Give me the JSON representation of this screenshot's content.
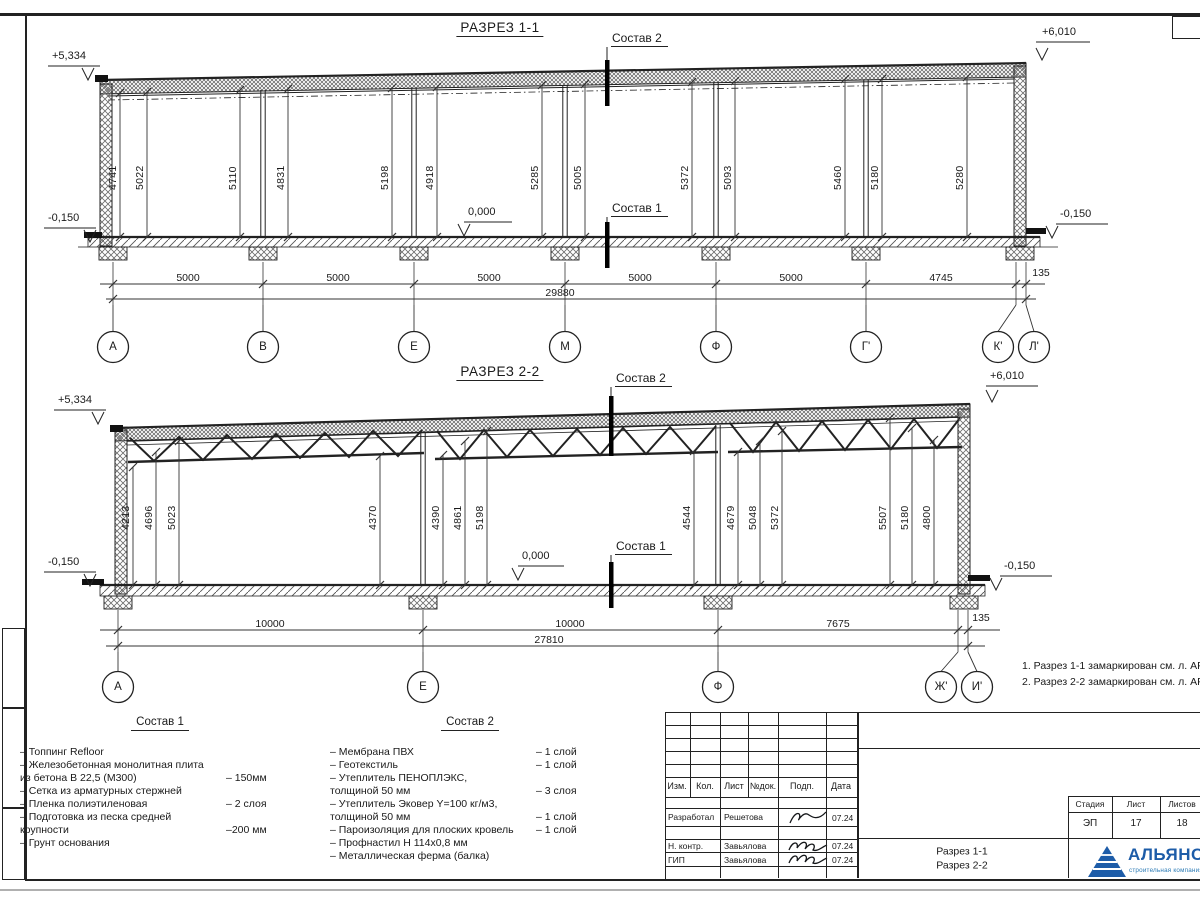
{
  "s1": {
    "title": "РАЗРЕЗ 1-1",
    "sostav2": "Состав 2",
    "sostav1": "Состав 1",
    "elev_top_left": "+5,334",
    "elev_top_right": "+6,010",
    "elev_bot_left": "-0,150",
    "elev_bot_right": "-0,150",
    "zero": "0,000",
    "vdims": [
      "4741",
      "5022",
      "5110",
      "4831",
      "5198",
      "4918",
      "5285",
      "5005",
      "5372",
      "5093",
      "5460",
      "5180",
      "5280"
    ],
    "hdims": [
      "5000",
      "5000",
      "5000",
      "5000",
      "5000",
      "4745",
      "135"
    ],
    "total": "29880",
    "axes": [
      "А",
      "В",
      "Е",
      "М",
      "Ф",
      "Г'",
      "К'",
      "Л'"
    ]
  },
  "s2": {
    "title": "РАЗРЕЗ 2-2",
    "sostav2": "Состав 2",
    "sostav1": "Состав 1",
    "elev_top_left": "+5,334",
    "elev_top_right": "+6,010",
    "elev_bot_left": "-0,150",
    "elev_bot_right": "-0,150",
    "zero": "0,000",
    "vdims": [
      "4213",
      "4696",
      "5023",
      "4370",
      "4390",
      "4861",
      "5198",
      "4544",
      "4679",
      "5048",
      "5372",
      "5507",
      "5180",
      "4800"
    ],
    "hdims": [
      "10000",
      "10000",
      "7675",
      "135"
    ],
    "total": "27810",
    "axes": [
      "А",
      "Е",
      "Ф",
      "Ж'",
      "И'"
    ]
  },
  "notes": [
    "1. Разрез 1-1 замаркирован см. л. АР-15",
    "2. Разрез 2-2 замаркирован см. л. АР-1"
  ],
  "legend1": {
    "title": "Состав 1",
    "items": [
      {
        "text": "– Топпинг Refloor",
        "value": ""
      },
      {
        "text": "– Железобетонная  монолитная плита\nиз бетона В 22,5 (М300)",
        "value": "– 150мм"
      },
      {
        "text": "– Сетка из арматурных стержней",
        "value": ""
      },
      {
        "text": "– Пленка полиэтиленовая",
        "value": "–  2 слоя"
      },
      {
        "text": "– Подготовка из песка средней\nкрупности",
        "value": "–200 мм"
      },
      {
        "text": "– Грунт основания",
        "value": ""
      }
    ]
  },
  "legend2": {
    "title": "Состав 2",
    "items": [
      {
        "text": "– Мембрана ПВХ",
        "value": "– 1 слой"
      },
      {
        "text": "– Геотекстиль",
        "value": "– 1 слой"
      },
      {
        "text": "– Утеплитель ПЕНОПЛЭКС,\nтолщиной 50 мм",
        "value": "– 3 слоя"
      },
      {
        "text": "– Утеплитель Эковер Y=100 кг/м3,\nтолщиной 50 мм",
        "value": "– 1 слой"
      },
      {
        "text": "– Пароизоляция для плоских кровель",
        "value": "– 1 слой"
      },
      {
        "text": "– Профнастил Н 114х0,8 мм",
        "value": ""
      },
      {
        "text": "– Металлическая ферма (балка)",
        "value": ""
      }
    ]
  },
  "stamp": {
    "headers": [
      "Изм.",
      "Кол.",
      "Лист",
      "№док.",
      "Подп.",
      "Дата"
    ],
    "rows": [
      {
        "role": "Разработал",
        "name": "Решетова",
        "date": "07.24"
      },
      {
        "role": "Н. контр.",
        "name": "Завьялова",
        "date": "07.24"
      },
      {
        "role": "ГИП",
        "name": "Завьялова",
        "date": "07.24"
      }
    ],
    "stage_headers": [
      "Стадия",
      "Лист",
      "Листов"
    ],
    "stage_values": [
      "ЭП",
      "17",
      "18"
    ],
    "doc_name": "Разрез 1-1\nРазрез 2-2",
    "logo": {
      "name": "АЛЬЯНС",
      "sub": "строительная компания",
      "color": "#1d5ca8"
    }
  }
}
